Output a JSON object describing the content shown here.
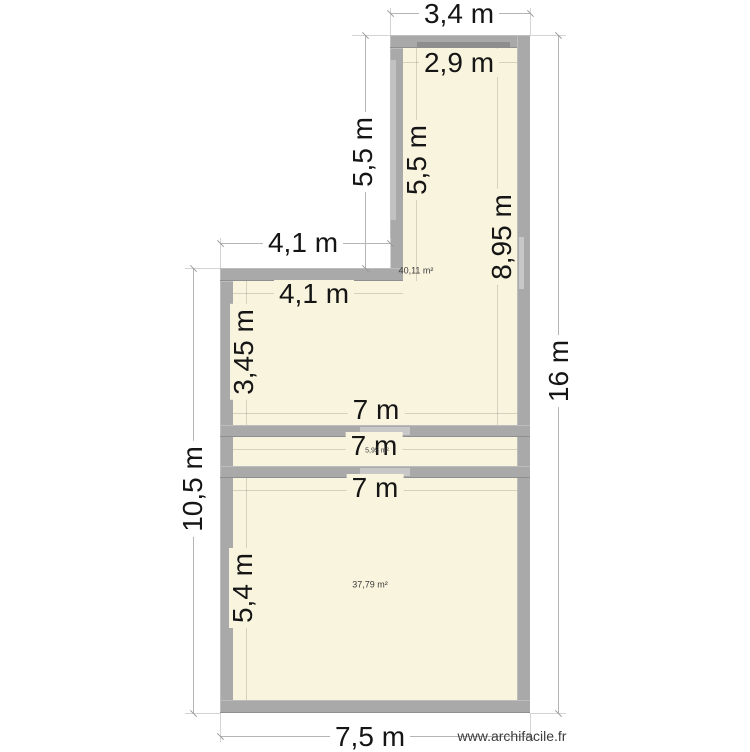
{
  "app": {
    "watermark": "www.archifacile.fr"
  },
  "colors": {
    "floor": "#f8f4de",
    "wall": "#a9a9a9",
    "wall_opening_light": "#c8c8c8",
    "wall_opening_dark": "#8d8d8d",
    "dimension_line": "#b5b5b5",
    "dimension_text": "#151515",
    "background": "#ffffff"
  },
  "rooms": [
    {
      "id": "upper-room",
      "area_label": "40,11 m²"
    },
    {
      "id": "strip-room",
      "area_label": "5,95 m²"
    },
    {
      "id": "lower-room",
      "area_label": "37,79 m²"
    }
  ],
  "dimensions": {
    "exterior": [
      {
        "id": "top-width",
        "label": "3,4 m"
      },
      {
        "id": "narrow-left-height",
        "label": "5,5 m"
      },
      {
        "id": "step-width",
        "label": "4,1 m"
      },
      {
        "id": "right-height",
        "label": "16 m"
      },
      {
        "id": "left-height",
        "label": "10,5 m"
      },
      {
        "id": "bottom-width",
        "label": "7,5 m"
      }
    ],
    "interior": [
      {
        "id": "top-inner-width",
        "label": "2,9 m"
      },
      {
        "id": "narrow-inner-height",
        "label": "5,5 m"
      },
      {
        "id": "right-inner-height",
        "label": "8,95 m"
      },
      {
        "id": "step-inner-width",
        "label": "4,1 m"
      },
      {
        "id": "upper-left-inner-height",
        "label": "3,45 m"
      },
      {
        "id": "upper-room-width",
        "label": "7 m"
      },
      {
        "id": "strip-width",
        "label": "7 m"
      },
      {
        "id": "lower-room-width",
        "label": "7 m"
      },
      {
        "id": "lower-left-inner-height",
        "label": "5,4 m"
      }
    ]
  }
}
